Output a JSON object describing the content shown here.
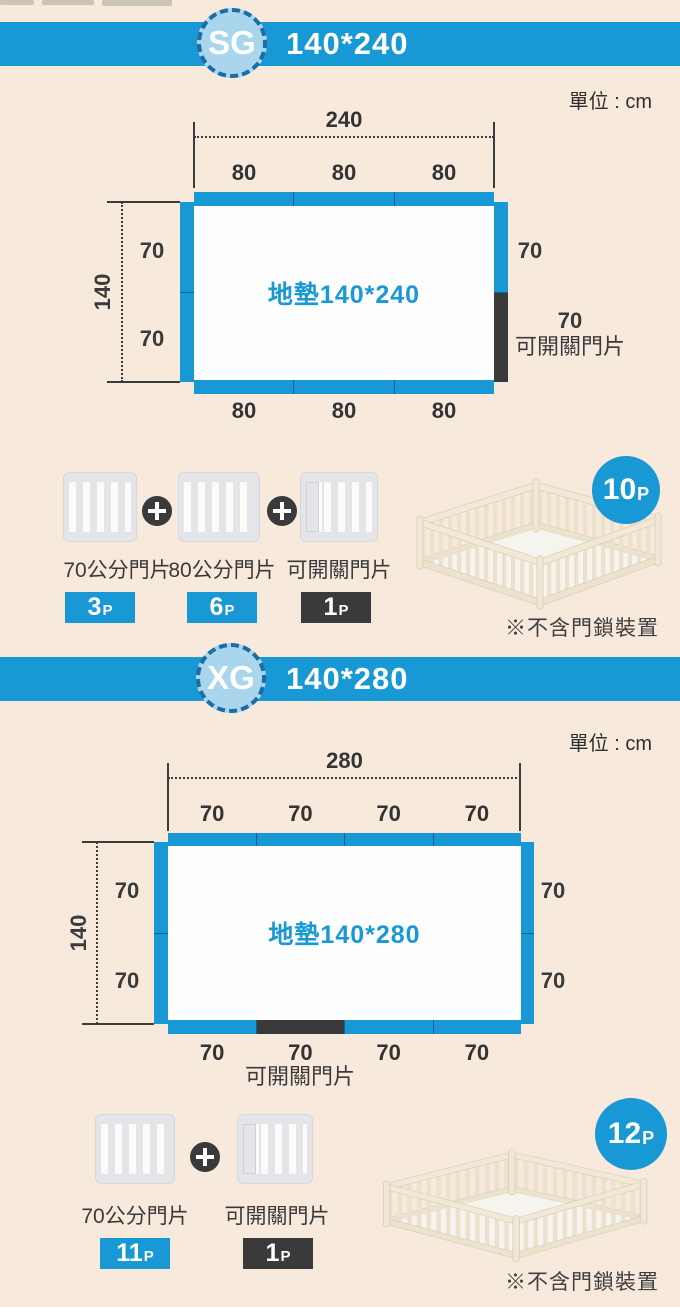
{
  "page": {
    "unit_label": "單位 : cm"
  },
  "sections": {
    "sg": {
      "model": "SG",
      "size": "140*240",
      "mat_label": "地墊140*240",
      "width_total": "240",
      "height_total": "140",
      "top_segments": [
        "80",
        "80",
        "80"
      ],
      "bottom_segments": [
        "80",
        "80",
        "80"
      ],
      "left_segments": [
        "70",
        "70"
      ],
      "right_upper": "70",
      "door_value": "70",
      "door_label": "可開關門片",
      "parts": {
        "p70": {
          "label": "70公分門片",
          "count": "3",
          "suffix": "P"
        },
        "p80": {
          "label": "80公分門片",
          "count": "6",
          "suffix": "P"
        },
        "door": {
          "label": "可開關門片",
          "count": "1",
          "suffix": "P"
        }
      },
      "total": {
        "count": "10",
        "suffix": "P"
      },
      "note": "※不含門鎖裝置"
    },
    "xg": {
      "model": "XG",
      "size": "140*280",
      "mat_label": "地墊140*280",
      "width_total": "280",
      "height_total": "140",
      "top_segments": [
        "70",
        "70",
        "70",
        "70"
      ],
      "bottom_segments": [
        "70",
        "70",
        "70",
        "70"
      ],
      "left_segments": [
        "70",
        "70"
      ],
      "right_segments": [
        "70",
        "70"
      ],
      "door_label": "可開關門片",
      "parts": {
        "p70": {
          "label": "70公分門片",
          "count": "11",
          "suffix": "P"
        },
        "door": {
          "label": "可開關門片",
          "count": "1",
          "suffix": "P"
        }
      },
      "total": {
        "count": "12",
        "suffix": "P"
      },
      "note": "※不含門鎖裝置"
    }
  },
  "colors": {
    "accent_blue": "#1899d5",
    "dark": "#3a3a3b",
    "circle_light_blue": "#a9d6ed",
    "background_cream": "#f7e9dc"
  }
}
